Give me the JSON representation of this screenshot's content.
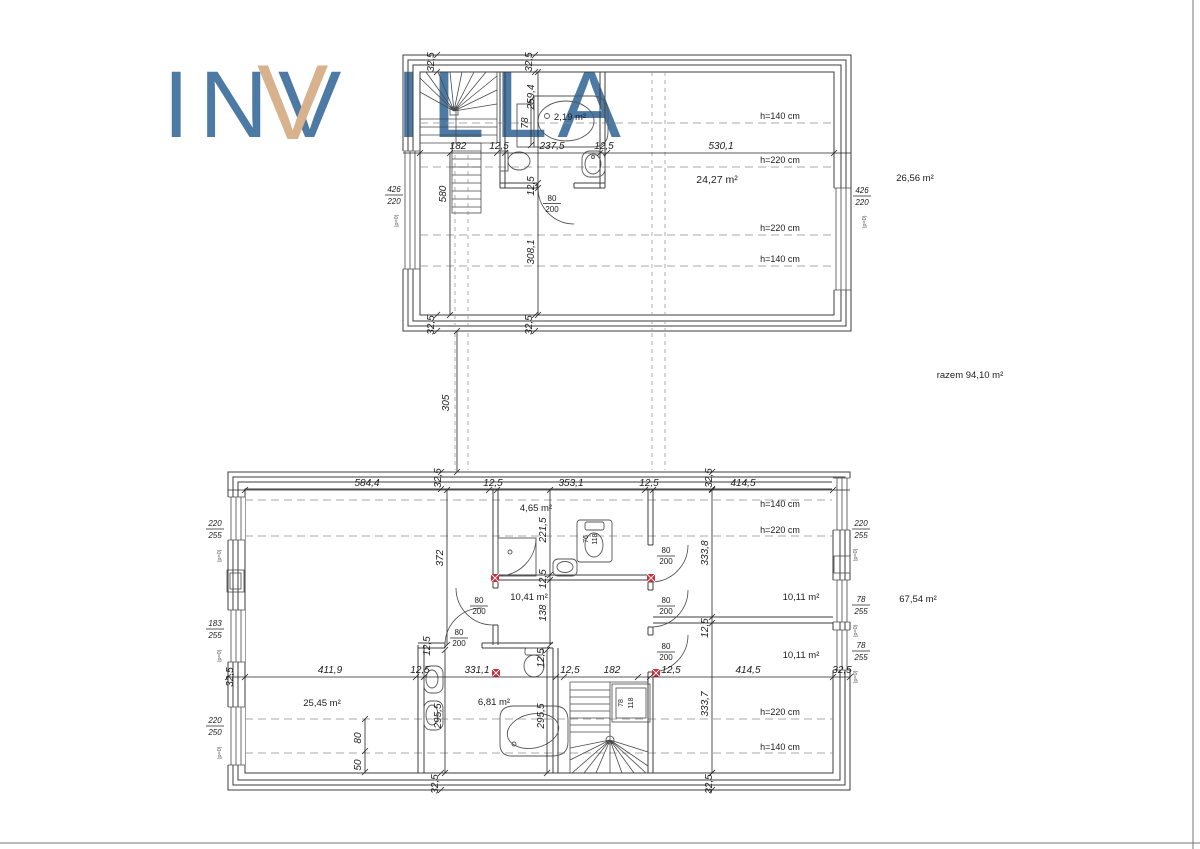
{
  "logo": {
    "in": "IN",
    "v": "V",
    "illa": "ILLA",
    "blue": "#4c7aa4",
    "tan": "#d8b28d"
  },
  "totals": {
    "upper_area": "26,56 m²",
    "lower_area": "67,54 m²",
    "combined": "razem 94,10 m²"
  },
  "common": {
    "door_w": "80",
    "door_h": "200",
    "p0": "(p=0)"
  },
  "between": {
    "gap": "305"
  },
  "upper": {
    "areas": {
      "bath": "2,19 m²",
      "attic": "24,27 m²"
    },
    "top_dims": [
      "32,5",
      "32,5"
    ],
    "bottom_dims": [
      "32,5",
      "32,5"
    ],
    "dimline": [
      "182",
      "12,5",
      "237,5",
      "12,5",
      "530,1"
    ],
    "vdims": {
      "v1": "259,4",
      "v2": "78",
      "v3": "12,5",
      "v4": "308,1",
      "v5": "580"
    },
    "heights": [
      "h=140 cm",
      "h=220 cm",
      "h=220 cm",
      "h=140 cm"
    ],
    "win_left": {
      "w": "426",
      "h": "220"
    },
    "win_right": {
      "w": "426",
      "h": "220"
    }
  },
  "lower": {
    "dimline_top": [
      "584,4",
      "12,5",
      "353,1",
      "12,5",
      "414,5"
    ],
    "top_rot": [
      "32,5",
      "32,5"
    ],
    "bottom_rot": [
      "32,5",
      "32,5"
    ],
    "left_rot": "32,5",
    "dimline_mid": [
      "411,9",
      "12,5",
      "331,1",
      "12,5",
      "182",
      "12,5",
      "414,5",
      "32,5"
    ],
    "areas": {
      "bath_top": "4,65 m²",
      "hall": "10,41 m²",
      "living": "25,45 m²",
      "bath": "6,81 m²",
      "room1": "10,11 m²",
      "room2": "10,11 m²"
    },
    "heights_upper": [
      "h=140 cm",
      "h=220 cm"
    ],
    "heights_lower": [
      "h=220 cm",
      "h=140 cm"
    ],
    "vdims": {
      "v372": "372",
      "v2215": "221,5",
      "v125a": "12,5",
      "v138": "138",
      "v3338": "333,8",
      "v125b": "12,5",
      "v3337": "333,7",
      "v2955a": "295,5",
      "v2955b": "295,5",
      "v125c": "12,5",
      "v125d": "12,5",
      "v80": "80",
      "v50": "50"
    },
    "win_left": [
      {
        "w": "220",
        "h": "255"
      },
      {
        "w": "183",
        "h": "255"
      },
      {
        "w": "220",
        "h": "250"
      }
    ],
    "win_right": [
      {
        "w": "220",
        "h": "255"
      },
      {
        "w": "78",
        "h": "255"
      },
      {
        "w": "78",
        "h": "255"
      }
    ],
    "closet": {
      "w": "78",
      "h": "118"
    },
    "toilet": {
      "w": "76",
      "h": "118"
    }
  }
}
